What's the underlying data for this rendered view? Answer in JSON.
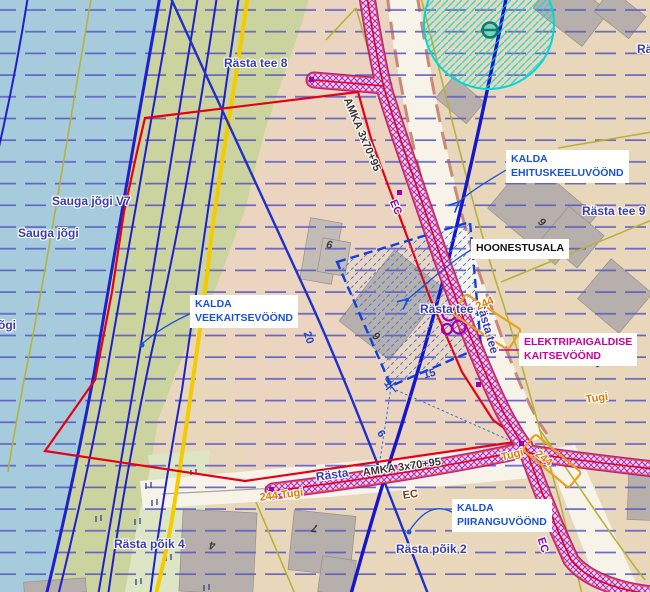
{
  "streets": {
    "rasta_tee_8": "Rästa tee 8",
    "rasta_tee_9": "Rästa tee 9",
    "rasta_tee_6": "Rästa tee 6",
    "rasta_tee_h": "Rästa tee",
    "rasta_tee_rot": "Rästa tee",
    "rasta_poik_4": "Rästa põik 4",
    "rasta_poik_2": "Rästa põik 2",
    "rasta_partial": "Rästa",
    "ra_partial": "Rä"
  },
  "water_labels": {
    "sauga_jogi_v7": "Sauga jõgi V7",
    "sauga_jogi": "Sauga jõgi",
    "ogi_partial": "õgi"
  },
  "annotations": {
    "ehituskeeluvoond_line1": "KALDA",
    "ehituskeeluvoond_line2": "EHITUSKEELUVÖÖND",
    "hoonestusala": "HOONESTUSALA",
    "veekaitsevoond_line1": "KALDA",
    "veekaitsevoond_line2": "VEEKAITSEVÖÖND",
    "elektripaigaldise_line1": "ELEKTRIPAIGALDISE",
    "elektripaigaldise_line2": "KAITSEVÖÖND",
    "piiranguvoond_line1": "KALDA",
    "piiranguvoond_line2": "PIIRANGUVÖÖND"
  },
  "powerline": {
    "amka_diagonal": "AMKA 3x70+95",
    "amka_horizontal": "AMKA 3x70+95",
    "ec_diagonal": "EC",
    "ec_horizontal": "EC",
    "ec_southeast": "EC",
    "tugi_right": "Tugi",
    "tugi_junction": "Tugi",
    "tugi_244_left": "244 Tugi",
    "pole_244_road": "244",
    "pole_244_junction": "244"
  },
  "dimensions": {
    "width_20": "20",
    "length_15": "15",
    "dim_1": "1",
    "dim_6": "6"
  },
  "building_numbers": {
    "num_6": "6",
    "num_9_envelope": "9",
    "num_9_right": "9",
    "num_7_right": "7",
    "num_4_bottom": "4",
    "num_7_bottom": "7"
  },
  "colors": {
    "water": "#a6cbdc",
    "green_zone": "#cbd49f",
    "land": "#e9d7bb",
    "road": "#f7f3e8",
    "red_boundary": "#e60016",
    "powerline_purple": "#9c00b4",
    "powerline_fill": "#f0d4ea",
    "cyan_zone": "#00d8d8",
    "annotation_blue": "#1b53d6",
    "magenta": "#cc00a0",
    "cadastral_yellow": "#f2cb00",
    "street_blue": "#3b3bb0",
    "tugi_orange": "#e07800",
    "zone_line_blue": "#1616c8"
  }
}
